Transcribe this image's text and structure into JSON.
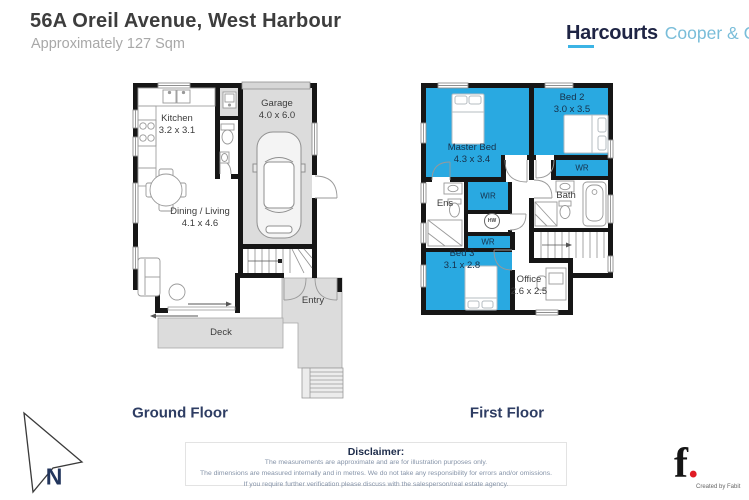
{
  "header": {
    "title": "56A Oreil Avenue, West Harbour",
    "subtitle": "Approximately 127 Sqm"
  },
  "brand": {
    "primary": "Harcourts",
    "secondary": "Cooper & Co"
  },
  "floors": {
    "ground": {
      "title": "Ground Floor",
      "rooms": {
        "kitchen": {
          "name": "Kitchen",
          "dims": "3.2 x 3.1"
        },
        "garage": {
          "name": "Garage",
          "dims": "4.0 x 6.0"
        },
        "dining": {
          "name": "Dining / Living",
          "dims": "4.1 x 4.6"
        },
        "deck": {
          "name": "Deck"
        },
        "entry": {
          "name": "Entry"
        }
      }
    },
    "first": {
      "title": "First Floor",
      "rooms": {
        "master": {
          "name": "Master Bed",
          "dims": "4.3 x 3.4"
        },
        "bed2": {
          "name": "Bed 2",
          "dims": "3.0 x 3.5"
        },
        "bed3": {
          "name": "Bed 3",
          "dims": "3.1 x 2.8"
        },
        "office": {
          "name": "Office",
          "dims": "2.6 x 2.5"
        },
        "wir": {
          "name": "WIR"
        },
        "wr_bed2": {
          "name": "WR"
        },
        "wr_bed3": {
          "name": "WR"
        },
        "ens": {
          "name": "Ens"
        },
        "bath": {
          "name": "Bath"
        },
        "hw": {
          "name": "HW"
        }
      }
    }
  },
  "compass": {
    "label": "N"
  },
  "disclaimer": {
    "title": "Disclaimer:",
    "lines": [
      "The measurements are approximate and are for illustration purposes only.",
      "The dimensions are measured internally and in metres. We do not take any responsibility for errors and/or omissions.",
      "If you require further verification please discuss with the salesperson/real estate agency."
    ]
  },
  "credit": {
    "mark": "f",
    "dot": ".",
    "text": "Created by Fabit"
  },
  "colors": {
    "highlight_blue": "#29a9e1",
    "floor_gray": "#dcdcdc",
    "wall": "#161616",
    "navy": "#2e3d63",
    "brand_navy": "#1e2444",
    "brand_blue": "#79bdd9",
    "accent_red": "#e01b24"
  }
}
